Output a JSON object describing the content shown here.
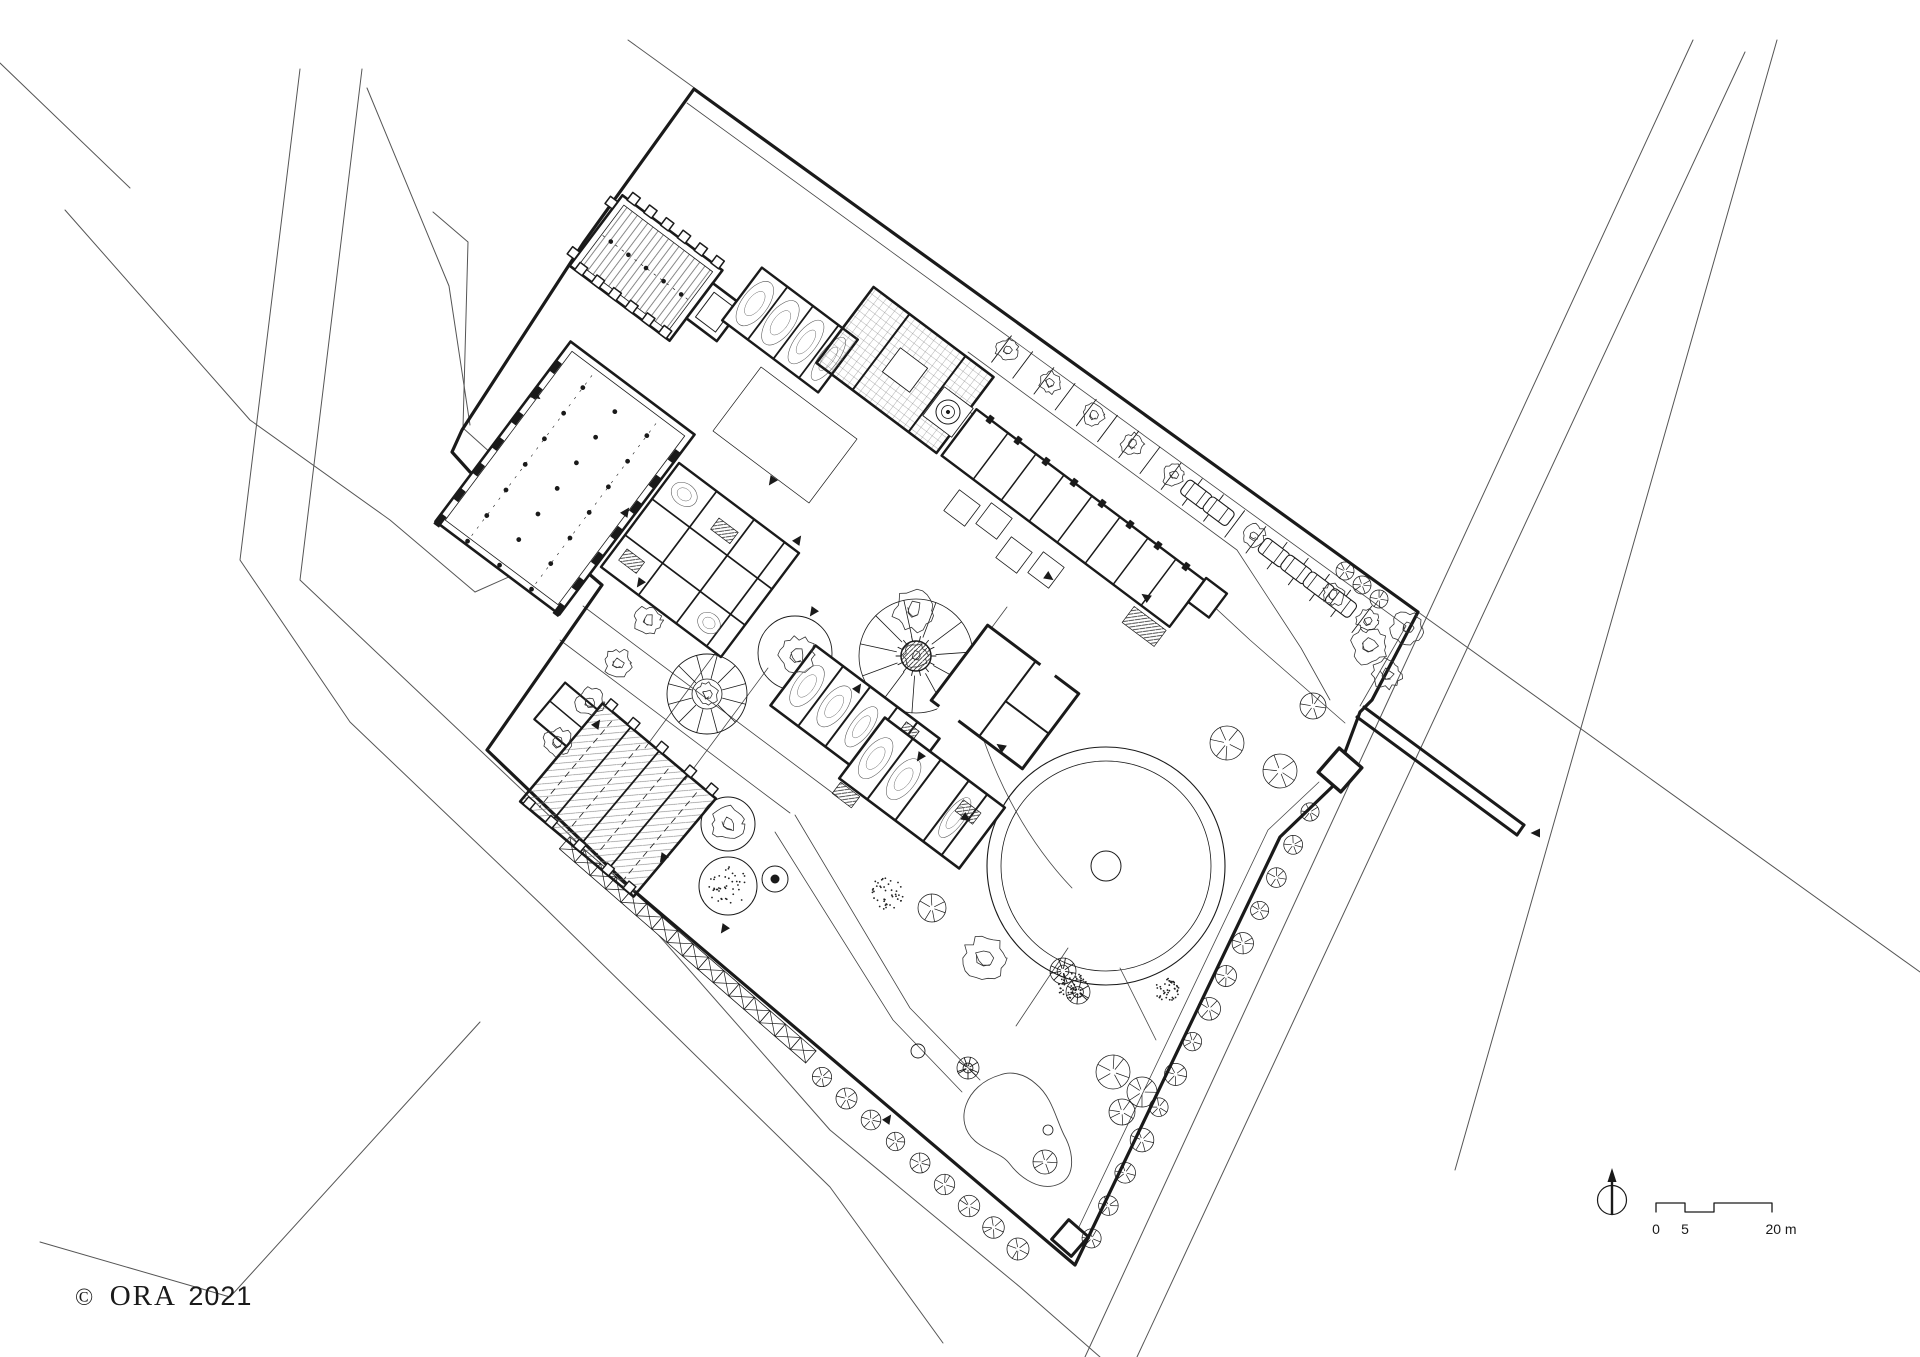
{
  "canvas": {
    "width": 1920,
    "height": 1357,
    "background": "#ffffff",
    "ink": "#1a1a1a"
  },
  "credit": {
    "symbol": "©",
    "name": "ORA",
    "year": "2021"
  },
  "scalebar": {
    "start": "0",
    "mid": "5",
    "end": "20 m",
    "units": "m"
  },
  "north_arrow": {
    "symbol": "circle-with-needle"
  },
  "plan_features": [
    "site-boundary-wall",
    "inner-boundary-line",
    "gate",
    "gate-pier-wall",
    "corner-post",
    "church-with-buttresses",
    "bell-tower",
    "vaulted-wing",
    "chapel-block-with-court",
    "spiral-stair-circle",
    "great-hall-with-column-grid",
    "kitchen-range",
    "dormitory-wing-north",
    "dormitory-wing-south",
    "garden-house",
    "stable-range",
    "tithe-barn-with-annex",
    "clipped-hedge",
    "parking-bays-with-cars-and-trees",
    "circular-lawn-with-basin",
    "radial-parterre",
    "sunflower-parterre",
    "round-tree-beds",
    "fountain-circle",
    "well",
    "kidney-pond",
    "boundary-tree-rows",
    "garden-trees",
    "door-arrows",
    "context-roads",
    "cloister-garth",
    "forecourt-planters"
  ]
}
